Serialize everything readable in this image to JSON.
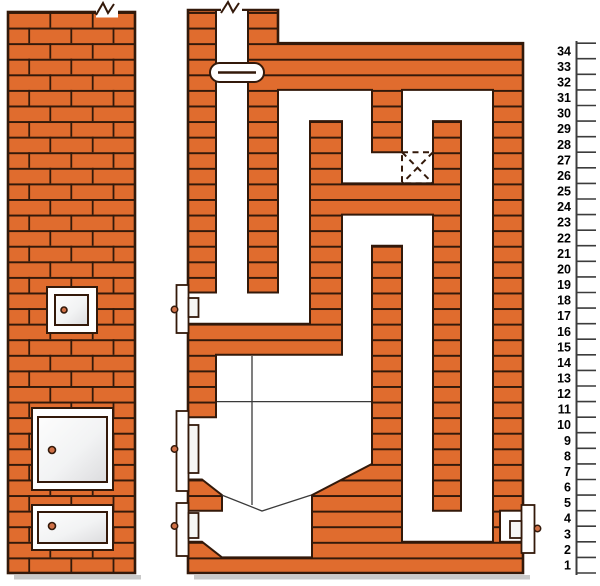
{
  "diagram": {
    "kind": "masonry-stove-technical-drawing",
    "views": [
      {
        "name": "front-elevation"
      },
      {
        "name": "vertical-cross-section"
      }
    ],
    "parts": [
      "chimney-flue",
      "damper",
      "break-mark",
      "soot-cleanout-door",
      "fire-door",
      "ash-door",
      "right-cleanout-door",
      "grate-funnel",
      "proposed-brick-marker",
      "flue-channels"
    ]
  },
  "scale": {
    "course_numbers": [
      34,
      33,
      32,
      31,
      30,
      29,
      28,
      27,
      26,
      25,
      24,
      23,
      22,
      21,
      20,
      19,
      18,
      17,
      16,
      15,
      14,
      13,
      12,
      11,
      10,
      9,
      8,
      7,
      6,
      5,
      4,
      3,
      2,
      1
    ]
  },
  "colors": {
    "brick": "#e06c2e",
    "outline": "#33190a",
    "white": "#ffffff",
    "door_panel_light": "#fdfdfd",
    "door_panel_shade": "#dcdcde",
    "knob": "#cf7046",
    "thin_line": "#3a3a3a",
    "ruler": "#3c3c3c",
    "shadow": "#c9c9c9"
  }
}
